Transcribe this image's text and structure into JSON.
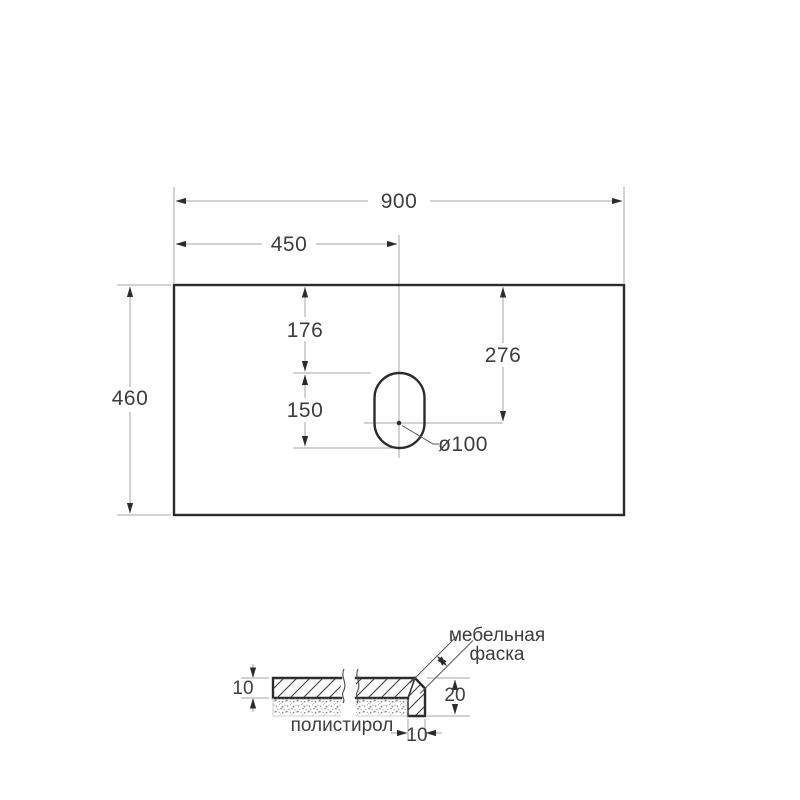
{
  "drawing": {
    "top_view": {
      "total_width": "900",
      "center_offset": "450",
      "total_depth": "460",
      "edge_to_hole_top": "176",
      "hole_length": "150",
      "edge_to_hole_center": "276",
      "hole_diameter": "ø100"
    },
    "section_view": {
      "top_thickness": "10",
      "edge_height": "20",
      "edge_width": "10",
      "chamfer_label_line1": "мебельная",
      "chamfer_label_line2": "фаска",
      "filler_label": "полистирол"
    },
    "colors": {
      "outline": "#2c2c2c",
      "dim_line": "#a6a6a6",
      "text": "#3d3d3d",
      "hatch": "#3f3f3f",
      "speckle": "#8f8f8f",
      "background": "#ffffff"
    }
  }
}
